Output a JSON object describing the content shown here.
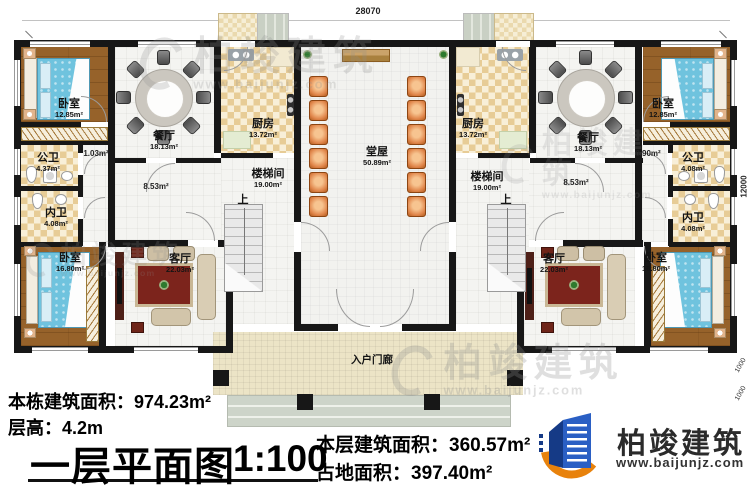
{
  "title_block": {
    "plan_name": "一层平面图",
    "scale": "1:100"
  },
  "stats": {
    "total": "本栋建筑面积：974.23m²",
    "height": "层高：4.2m",
    "floor": "本层建筑面积：360.57m²",
    "land": "占地面积：397.40m²"
  },
  "brand": {
    "name": "柏竣建筑",
    "url": "www.baijunjz.com"
  },
  "watermark": {
    "name": "柏竣建筑",
    "url": "www.baijunjz.com"
  },
  "dimensions": {
    "top": "28070",
    "right": "12000",
    "right_a": "1000",
    "right_b": "1000"
  },
  "rooms": {
    "bedroom_tl": {
      "name": "卧室",
      "area": "12.85m²"
    },
    "bedroom_tr": {
      "name": "卧室",
      "area": "12.85m²"
    },
    "bedroom_bl": {
      "name": "卧室",
      "area": "16.80m²"
    },
    "bedroom_br": {
      "name": "卧室",
      "area": "16.80m²"
    },
    "dining_left": {
      "name": "餐厅",
      "area": "18.13m²"
    },
    "dining_right": {
      "name": "餐厅",
      "area": "18.13m²"
    },
    "kitchen_left": {
      "name": "厨房",
      "area": "13.72m²"
    },
    "kitchen_right": {
      "name": "厨房",
      "area": "13.72m²"
    },
    "hall": {
      "name": "堂屋",
      "area": "50.89m²"
    },
    "stairwell_left": {
      "name": "楼梯间",
      "area": "19.00m²"
    },
    "stairwell_right": {
      "name": "楼梯间",
      "area": "19.00m²"
    },
    "living_left": {
      "name": "客厅",
      "area": "22.03m²"
    },
    "living_right": {
      "name": "客厅",
      "area": "22.03m²"
    },
    "public_bath_left": {
      "name": "公卫",
      "area": "4.37m²"
    },
    "public_bath_right": {
      "name": "公卫",
      "area": "4.08m²"
    },
    "private_bath_left": {
      "name": "内卫",
      "area": "4.08m²"
    },
    "private_bath_right": {
      "name": "内卫",
      "area": "4.08m²"
    },
    "porch": {
      "name": "入户门廊"
    }
  },
  "annotations": {
    "up_left": "上",
    "up_right": "上",
    "gap_left": "1.03m²",
    "gap_right": "0.90m²",
    "corridor_left": "8.53m²",
    "corridor_right": "8.53m²"
  }
}
